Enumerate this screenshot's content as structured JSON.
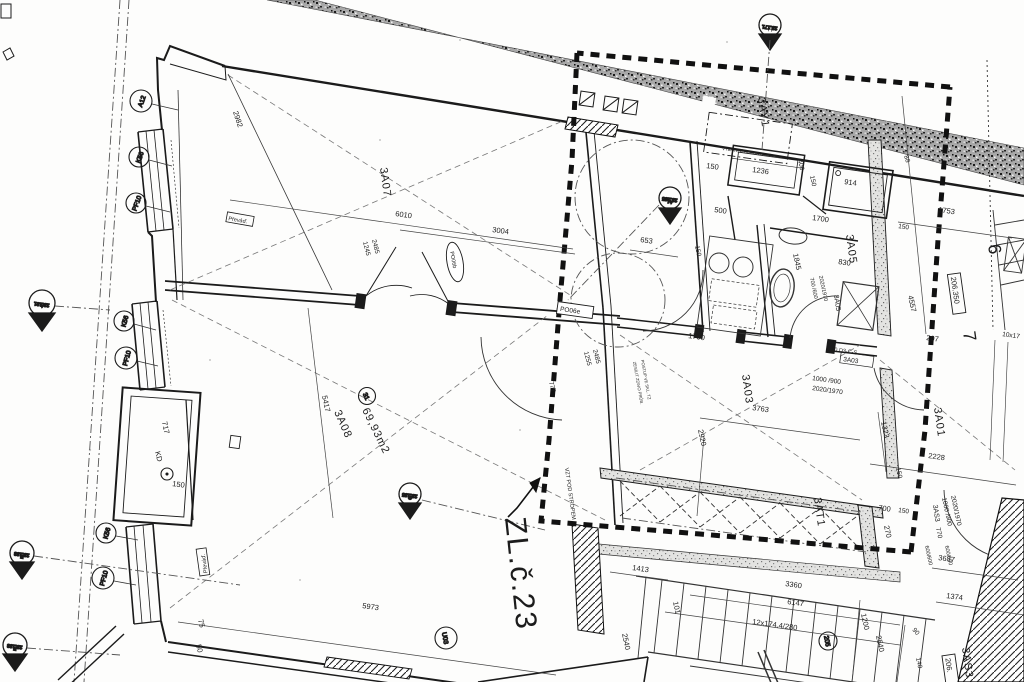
{
  "title": "ZL.č.23",
  "rooms": {
    "r3a07": "3A07",
    "r3a08": "3A08",
    "r3a01": "3A01",
    "r3a03": "3A03",
    "r3a05": "3A05",
    "r3a05s": "3A05",
    "r3at1": "3AT1",
    "r3ay1": "3AY1",
    "r3as3": "3AS3",
    "r3as3s": "3AS3",
    "area3a08": "69,93m2",
    "num31": "31"
  },
  "axes": {
    "a12": "A12",
    "k56a": "K56",
    "k56b": "K56",
    "k56c": "K56",
    "pf10a": "PF10",
    "pf10b": "PF10",
    "pf10c": "PF10",
    "kd": "KD",
    "u03": "U03",
    "c205": "205",
    "grid6": "6",
    "grid7": "7"
  },
  "levels": {
    "lvl206a": "206.350",
    "lvl206b": "206."
  },
  "marks": {
    "mh_v": "23.171",
    "mh_l": "H",
    "ma1_v": "23.185",
    "ma1_l": "A1",
    "mg_v": "23.185",
    "mg_l": "G",
    "ma_v": "23.181",
    "ma_l": "A",
    "me_v": "23.183",
    "me_l": "E",
    "mf_v": "23.183",
    "mf_l": "F"
  },
  "notes": {
    "vzt": "VZT POD STROPEM",
    "zes1": "ZESÍLIT ZDIVO PRŮB.",
    "zes2": "POSTUP VE SKL. TZ",
    "vyb": "VYBAVENÍ DEMONTOVAT",
    "prev1": "Převáď.",
    "prev2": "Převáď.",
    "po06e": "PO06e",
    "po06b": "PO06b",
    "b30": "B 30 D3-C-S",
    "box3a03": "3A03",
    "stair": "12x174.4/280",
    "d10x": "10x17"
  },
  "dims": {
    "d2982": "2982",
    "d6010": "6010",
    "d3004": "3004",
    "d1245": "1245",
    "d2485a": "2485",
    "d1255": "1255",
    "d2485b": "2485",
    "d777": "777",
    "d653": "653",
    "d5417": "5417",
    "d717": "717",
    "d150kd": "150",
    "d5973": "5973",
    "d75": "75",
    "d50": "50",
    "d2920": "2920",
    "d3763": "3763",
    "d1413": "1413",
    "d101": "101",
    "d2540a": "2540",
    "d3360": "3360",
    "d6147": "6147",
    "d1200": "1200",
    "d2540b": "2540",
    "d140": "140",
    "d1374": "1374",
    "d3687": "3687",
    "d2228": "2228",
    "d1323": "1323",
    "d150e": "150",
    "d207": "207",
    "d4557": "4557",
    "d1753": "1753",
    "d150a": "150",
    "d88": "88",
    "d914": "914",
    "d1236": "1236",
    "d150b": "150",
    "d400": "400",
    "d150c": "150",
    "d500": "500",
    "d150d": "150",
    "d1700a": "1700",
    "d1700b": "1700",
    "d1845": "1845",
    "d830": "830",
    "dd700": "700 /600",
    "dd2020a": "2020/1970",
    "dd1000a": "1000 /900",
    "dd2020b": "2020/1970",
    "dd1000b": "1000 /900",
    "dd2020c": "2020/1970",
    "d700b": "700",
    "d150g": "150",
    "d270": "270",
    "d770": "770",
    "d600a": "600/600",
    "d600b": "600/600",
    "d90": "90"
  },
  "colors": {
    "ink": "#1b1b1b",
    "stipple": "#a8a8a8",
    "paper": "#fdfdfc"
  }
}
